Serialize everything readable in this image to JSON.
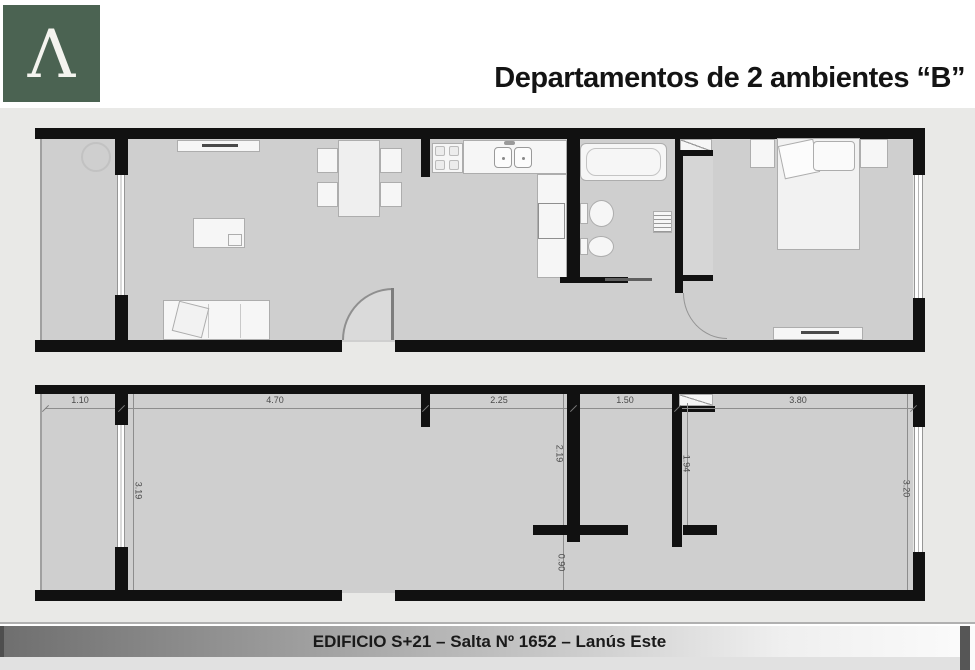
{
  "header": {
    "logo_letter": "Λ",
    "title": "Departamentos de 2 ambientes “B”"
  },
  "footer": {
    "text": "EDIFICIO S+21 – Salta Nº 1652 – Lanús Este"
  },
  "colors": {
    "logo_green": "#4b6352",
    "wall_black": "#111111",
    "floor_gray": "#cfcfcf",
    "page_gray": "#e9e9e7"
  },
  "dimensions": {
    "horizontal": [
      "1.10",
      "4.70",
      "2.25",
      "1.50",
      "3.80"
    ],
    "vertical": [
      "3.19",
      "2.19",
      "0.90",
      "1.94",
      "3.20"
    ]
  }
}
